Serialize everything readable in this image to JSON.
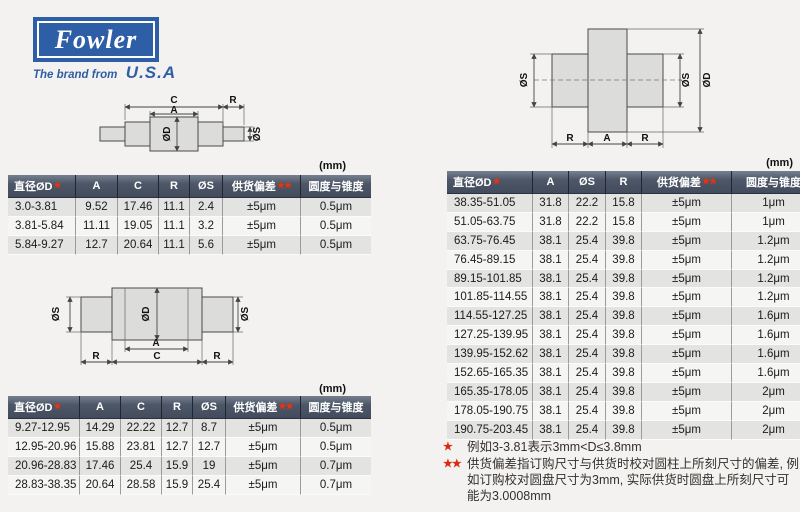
{
  "logo": {
    "brand": "Fowler",
    "tagline": "The brand from",
    "country": "U.S.A"
  },
  "colors": {
    "logo_blue": "#2e5fa6",
    "table_header_bg": "#4d5768",
    "star_red": "#e8320f",
    "row_alt": "#e3e3e2",
    "row_base": "#f5f5f4"
  },
  "diagram_labels": {
    "c": "C",
    "a": "A",
    "r": "R",
    "od": "ØD",
    "os": "ØS"
  },
  "tables": {
    "top_left": {
      "unit": "(mm)",
      "headers": [
        "直径ØD",
        "A",
        "C",
        "R",
        "ØS",
        "供货偏差",
        "圆度与锥度"
      ],
      "header_stars": [
        1,
        0,
        0,
        0,
        0,
        2,
        0
      ],
      "col_widths": [
        60,
        39,
        38,
        28,
        30,
        75,
        68
      ],
      "rows": [
        [
          "3.0-3.81",
          "9.52",
          "17.46",
          "11.1",
          "2.4",
          "±5μm",
          "0.5μm"
        ],
        [
          "3.81-5.84",
          "11.11",
          "19.05",
          "11.1",
          "3.2",
          "±5μm",
          "0.5μm"
        ],
        [
          "5.84-9.27",
          "12.7",
          "20.64",
          "11.1",
          "5.6",
          "±5μm",
          "0.5μm"
        ]
      ]
    },
    "bottom_left": {
      "unit": "(mm)",
      "headers": [
        "直径ØD",
        "A",
        "C",
        "R",
        "ØS",
        "供货偏差",
        "圆度与锥度"
      ],
      "header_stars": [
        1,
        0,
        0,
        0,
        0,
        2,
        0
      ],
      "col_widths": [
        64,
        38,
        38,
        28,
        30,
        72,
        68
      ],
      "rows": [
        [
          "9.27-12.95",
          "14.29",
          "22.22",
          "12.7",
          "8.7",
          "±5μm",
          "0.5μm"
        ],
        [
          "12.95-20.96",
          "15.88",
          "23.81",
          "12.7",
          "12.7",
          "±5μm",
          "0.5μm"
        ],
        [
          "20.96-28.83",
          "17.46",
          "25.4",
          "15.9",
          "19",
          "±5μm",
          "0.7μm"
        ],
        [
          "28.83-38.35",
          "20.64",
          "28.58",
          "15.9",
          "25.4",
          "±5μm",
          "0.7μm"
        ]
      ]
    },
    "right": {
      "unit": "(mm)",
      "headers": [
        "直径ØD",
        "A",
        "ØS",
        "R",
        "供货偏差",
        "圆度与锥度"
      ],
      "header_stars": [
        1,
        0,
        0,
        0,
        2,
        0
      ],
      "col_widths": [
        78,
        33,
        34,
        33,
        87,
        81
      ],
      "rows": [
        [
          "38.35-51.05",
          "31.8",
          "22.2",
          "15.8",
          "±5μm",
          "1μm"
        ],
        [
          "51.05-63.75",
          "31.8",
          "22.2",
          "15.8",
          "±5μm",
          "1μm"
        ],
        [
          "63.75-76.45",
          "38.1",
          "25.4",
          "39.8",
          "±5μm",
          "1.2μm"
        ],
        [
          "76.45-89.15",
          "38.1",
          "25.4",
          "39.8",
          "±5μm",
          "1.2μm"
        ],
        [
          "89.15-101.85",
          "38.1",
          "25.4",
          "39.8",
          "±5μm",
          "1.2μm"
        ],
        [
          "101.85-114.55",
          "38.1",
          "25.4",
          "39.8",
          "±5μm",
          "1.2μm"
        ],
        [
          "114.55-127.25",
          "38.1",
          "25.4",
          "39.8",
          "±5μm",
          "1.6μm"
        ],
        [
          "127.25-139.95",
          "38.1",
          "25.4",
          "39.8",
          "±5μm",
          "1.6μm"
        ],
        [
          "139.95-152.62",
          "38.1",
          "25.4",
          "39.8",
          "±5μm",
          "1.6μm"
        ],
        [
          "152.65-165.35",
          "38.1",
          "25.4",
          "39.8",
          "±5μm",
          "1.6μm"
        ],
        [
          "165.35-178.05",
          "38.1",
          "25.4",
          "39.8",
          "±5μm",
          "2μm"
        ],
        [
          "178.05-190.75",
          "38.1",
          "25.4",
          "39.8",
          "±5μm",
          "2μm"
        ],
        [
          "190.75-203.45",
          "38.1",
          "25.4",
          "39.8",
          "±5μm",
          "2μm"
        ]
      ]
    }
  },
  "footnotes": [
    {
      "marker": "★",
      "text": "例如3-3.81表示3mm<D≤3.8mm"
    },
    {
      "marker": "★★",
      "text": "供货偏差指订购尺寸与供货时校对圆柱上所刻尺寸的偏差, 例如订购校对圆盘尺寸为3mm, 实际供货时圆盘上所刻尺寸可能为3.0008mm"
    }
  ]
}
